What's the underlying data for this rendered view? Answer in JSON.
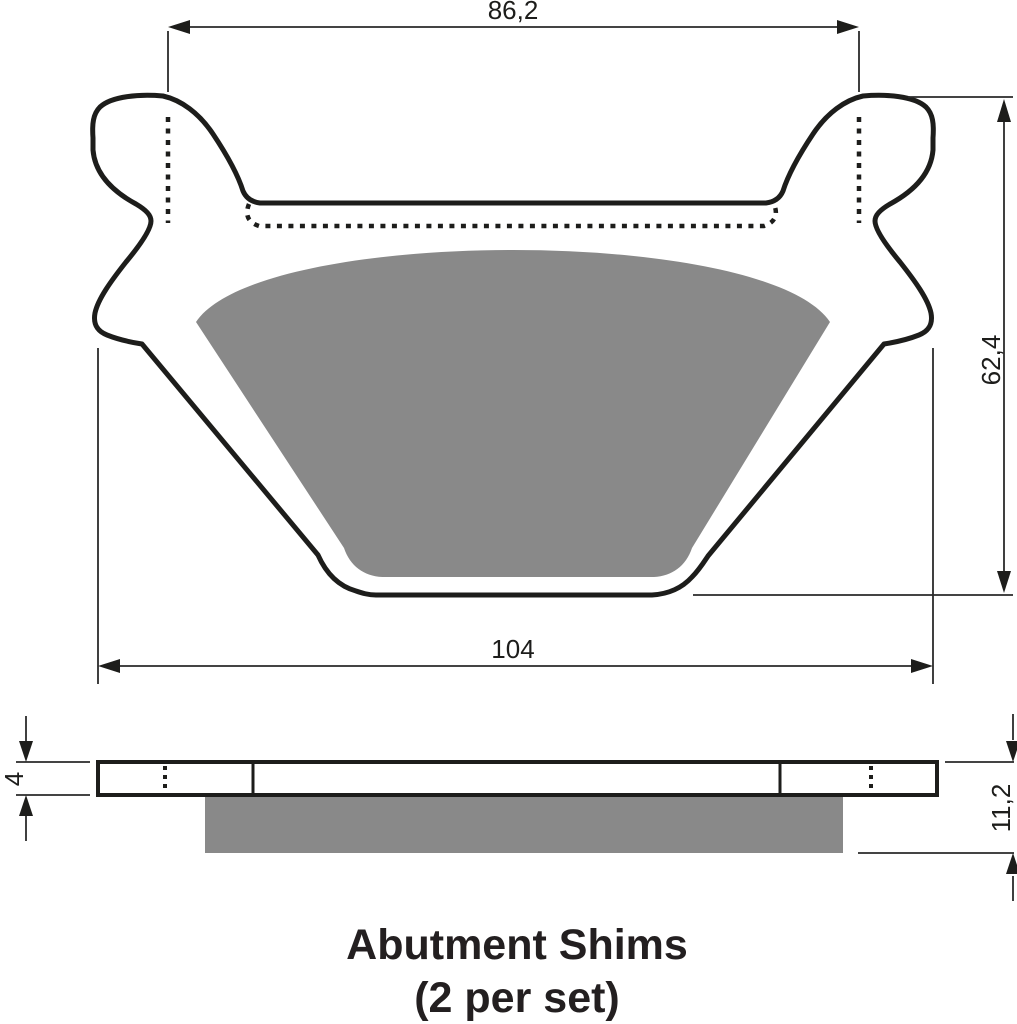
{
  "drawing": {
    "kind": "technical-dimension-drawing",
    "title_line1": "Abutment Shims",
    "title_line2": "(2 per set)",
    "top_view": {
      "dim_top_width": "86,2",
      "dim_bottom_width": "104",
      "dim_height": "62,4"
    },
    "side_view": {
      "dim_backplate_thickness": "4",
      "dim_total_thickness": "11,2"
    },
    "colors": {
      "line": "#1d1d1b",
      "friction_gray": "#898989",
      "background": "#ffffff",
      "title_text": "#231f20"
    }
  }
}
